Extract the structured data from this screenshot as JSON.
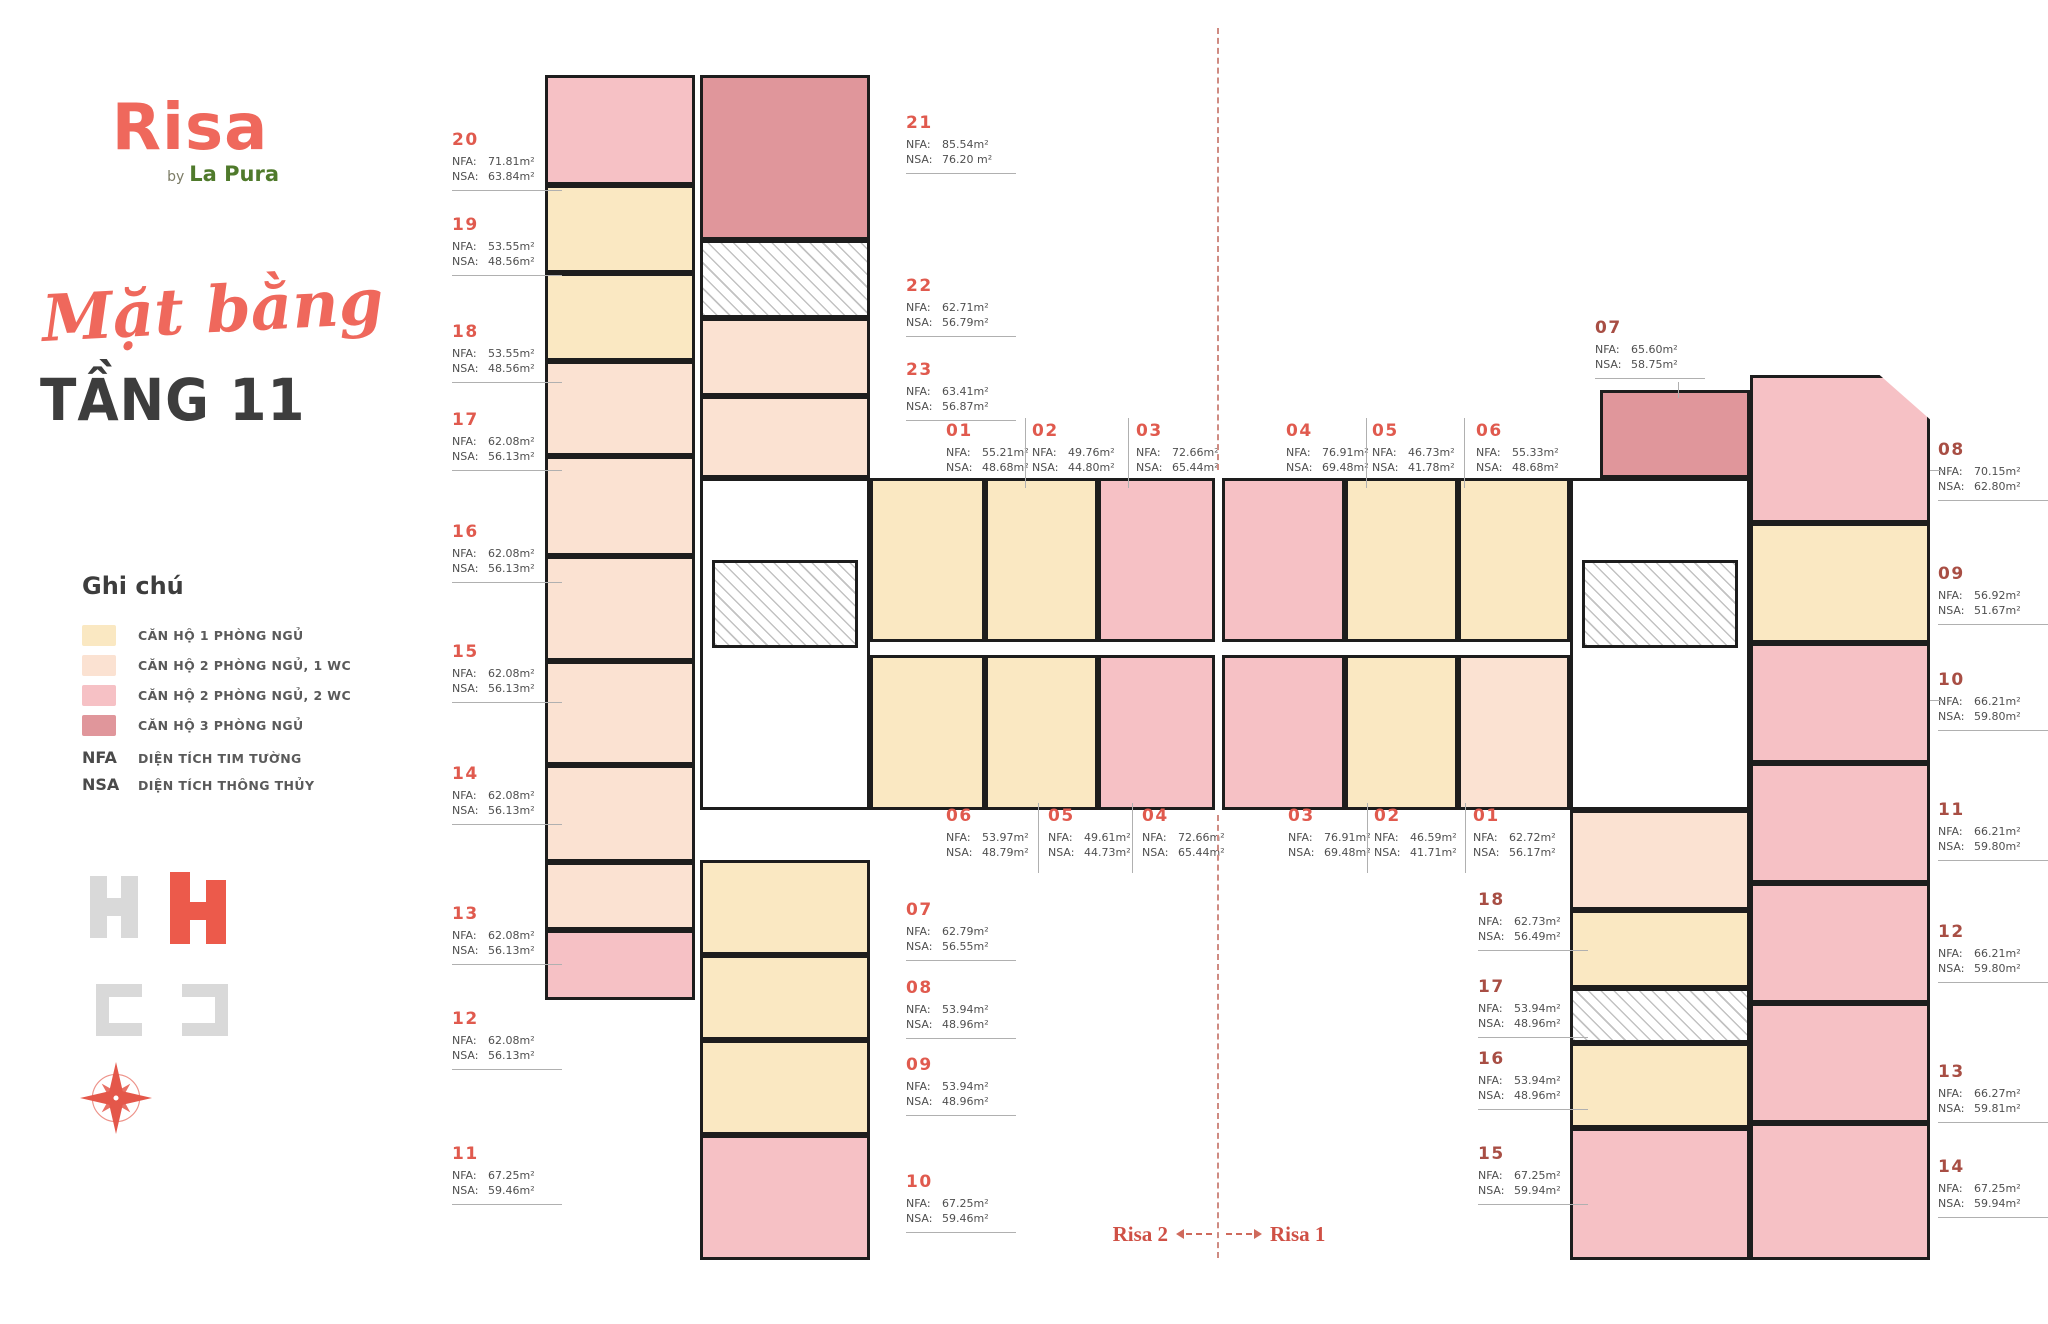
{
  "brand": {
    "logo_text": "Risa",
    "by": "by",
    "sub": "La Pura"
  },
  "title": {
    "script": "Mặt bằng",
    "floor": "TẦNG 11"
  },
  "legend": {
    "heading": "Ghi chú",
    "items": [
      {
        "key": "t1",
        "label": "CĂN HỘ 1 PHÒNG NGỦ",
        "color": "#FAE8C2"
      },
      {
        "key": "t2",
        "label": "CĂN HỘ 2 PHÒNG NGỦ, 1 WC",
        "color": "#FBE2D2"
      },
      {
        "key": "t3",
        "label": "CĂN HỘ 2 PHÒNG NGỦ, 2 WC",
        "color": "#F6C1C5"
      },
      {
        "key": "t4",
        "label": "CĂN HỘ 3 PHÒNG NGỦ",
        "color": "#E0969B"
      }
    ],
    "abbrs": [
      {
        "key": "NFA",
        "label": "DIỆN TÍCH TIM TƯỜNG"
      },
      {
        "key": "NSA",
        "label": "DIỆN TÍCH THÔNG THỦY"
      }
    ]
  },
  "field_labels": {
    "nfa": "NFA:",
    "nsa": "NSA:"
  },
  "footer": {
    "left": "Risa 2",
    "right": "Risa 1"
  },
  "colors": {
    "brand_coral": "#EF685C",
    "brand_green": "#4F7A2B",
    "title_dark": "#3D3D3D",
    "unit_no_left": "#E05A4E",
    "unit_no_right": "#A84E44",
    "wall": "#1D1D1D"
  },
  "unit_groups": {
    "left_outer": [
      {
        "no": "20",
        "nfa": "71.81m²",
        "nsa": "63.84m²"
      },
      {
        "no": "19",
        "nfa": "53.55m²",
        "nsa": "48.56m²"
      },
      {
        "no": "18",
        "nfa": "53.55m²",
        "nsa": "48.56m²"
      },
      {
        "no": "17",
        "nfa": "62.08m²",
        "nsa": "56.13m²"
      },
      {
        "no": "16",
        "nfa": "62.08m²",
        "nsa": "56.13m²"
      },
      {
        "no": "15",
        "nfa": "62.08m²",
        "nsa": "56.13m²"
      },
      {
        "no": "14",
        "nfa": "62.08m²",
        "nsa": "56.13m²"
      },
      {
        "no": "13",
        "nfa": "62.08m²",
        "nsa": "56.13m²"
      },
      {
        "no": "12",
        "nfa": "62.08m²",
        "nsa": "56.13m²"
      },
      {
        "no": "11",
        "nfa": "67.25m²",
        "nsa": "59.46m²"
      }
    ],
    "risa2_inner_top": [
      {
        "no": "21",
        "nfa": "85.54m²",
        "nsa": "76.20 m²"
      },
      {
        "no": "22",
        "nfa": "62.71m²",
        "nsa": "56.79m²"
      },
      {
        "no": "23",
        "nfa": "63.41m²",
        "nsa": "56.87m²"
      }
    ],
    "center_top": [
      {
        "no": "01",
        "nfa": "55.21m²",
        "nsa": "48.68m²"
      },
      {
        "no": "02",
        "nfa": "49.76m²",
        "nsa": "44.80m²"
      },
      {
        "no": "03",
        "nfa": "72.66m²",
        "nsa": "65.44m²"
      },
      {
        "no": "04",
        "nfa": "76.91m²",
        "nsa": "69.48m²"
      },
      {
        "no": "05",
        "nfa": "46.73m²",
        "nsa": "41.78m²"
      },
      {
        "no": "06",
        "nfa": "55.33m²",
        "nsa": "48.68m²"
      }
    ],
    "center_bottom": [
      {
        "no": "06",
        "nfa": "53.97m²",
        "nsa": "48.79m²"
      },
      {
        "no": "05",
        "nfa": "49.61m²",
        "nsa": "44.73m²"
      },
      {
        "no": "04",
        "nfa": "72.66m²",
        "nsa": "65.44m²"
      },
      {
        "no": "03",
        "nfa": "76.91m²",
        "nsa": "69.48m²"
      },
      {
        "no": "02",
        "nfa": "46.59m²",
        "nsa": "41.71m²"
      },
      {
        "no": "01",
        "nfa": "62.72m²",
        "nsa": "56.17m²"
      }
    ],
    "risa2_inner_bottom": [
      {
        "no": "07",
        "nfa": "62.79m²",
        "nsa": "56.55m²"
      },
      {
        "no": "08",
        "nfa": "53.94m²",
        "nsa": "48.96m²"
      },
      {
        "no": "09",
        "nfa": "53.94m²",
        "nsa": "48.96m²"
      },
      {
        "no": "10",
        "nfa": "67.25m²",
        "nsa": "59.46m²"
      }
    ],
    "risa1_top": [
      {
        "no": "07",
        "nfa": "65.60m²",
        "nsa": "58.75m²"
      }
    ],
    "risa1_right": [
      {
        "no": "08",
        "nfa": "70.15m²",
        "nsa": "62.80m²"
      },
      {
        "no": "09",
        "nfa": "56.92m²",
        "nsa": "51.67m²"
      },
      {
        "no": "10",
        "nfa": "66.21m²",
        "nsa": "59.80m²"
      },
      {
        "no": "11",
        "nfa": "66.21m²",
        "nsa": "59.80m²"
      },
      {
        "no": "12",
        "nfa": "66.21m²",
        "nsa": "59.80m²"
      },
      {
        "no": "13",
        "nfa": "66.27m²",
        "nsa": "59.81m²"
      },
      {
        "no": "14",
        "nfa": "67.25m²",
        "nsa": "59.94m²"
      }
    ],
    "risa1_inner": [
      {
        "no": "18",
        "nfa": "62.73m²",
        "nsa": "56.49m²"
      },
      {
        "no": "17",
        "nfa": "53.94m²",
        "nsa": "48.96m²"
      },
      {
        "no": "16",
        "nfa": "53.94m²",
        "nsa": "48.96m²"
      },
      {
        "no": "15",
        "nfa": "67.25m²",
        "nsa": "59.94m²"
      }
    ]
  }
}
